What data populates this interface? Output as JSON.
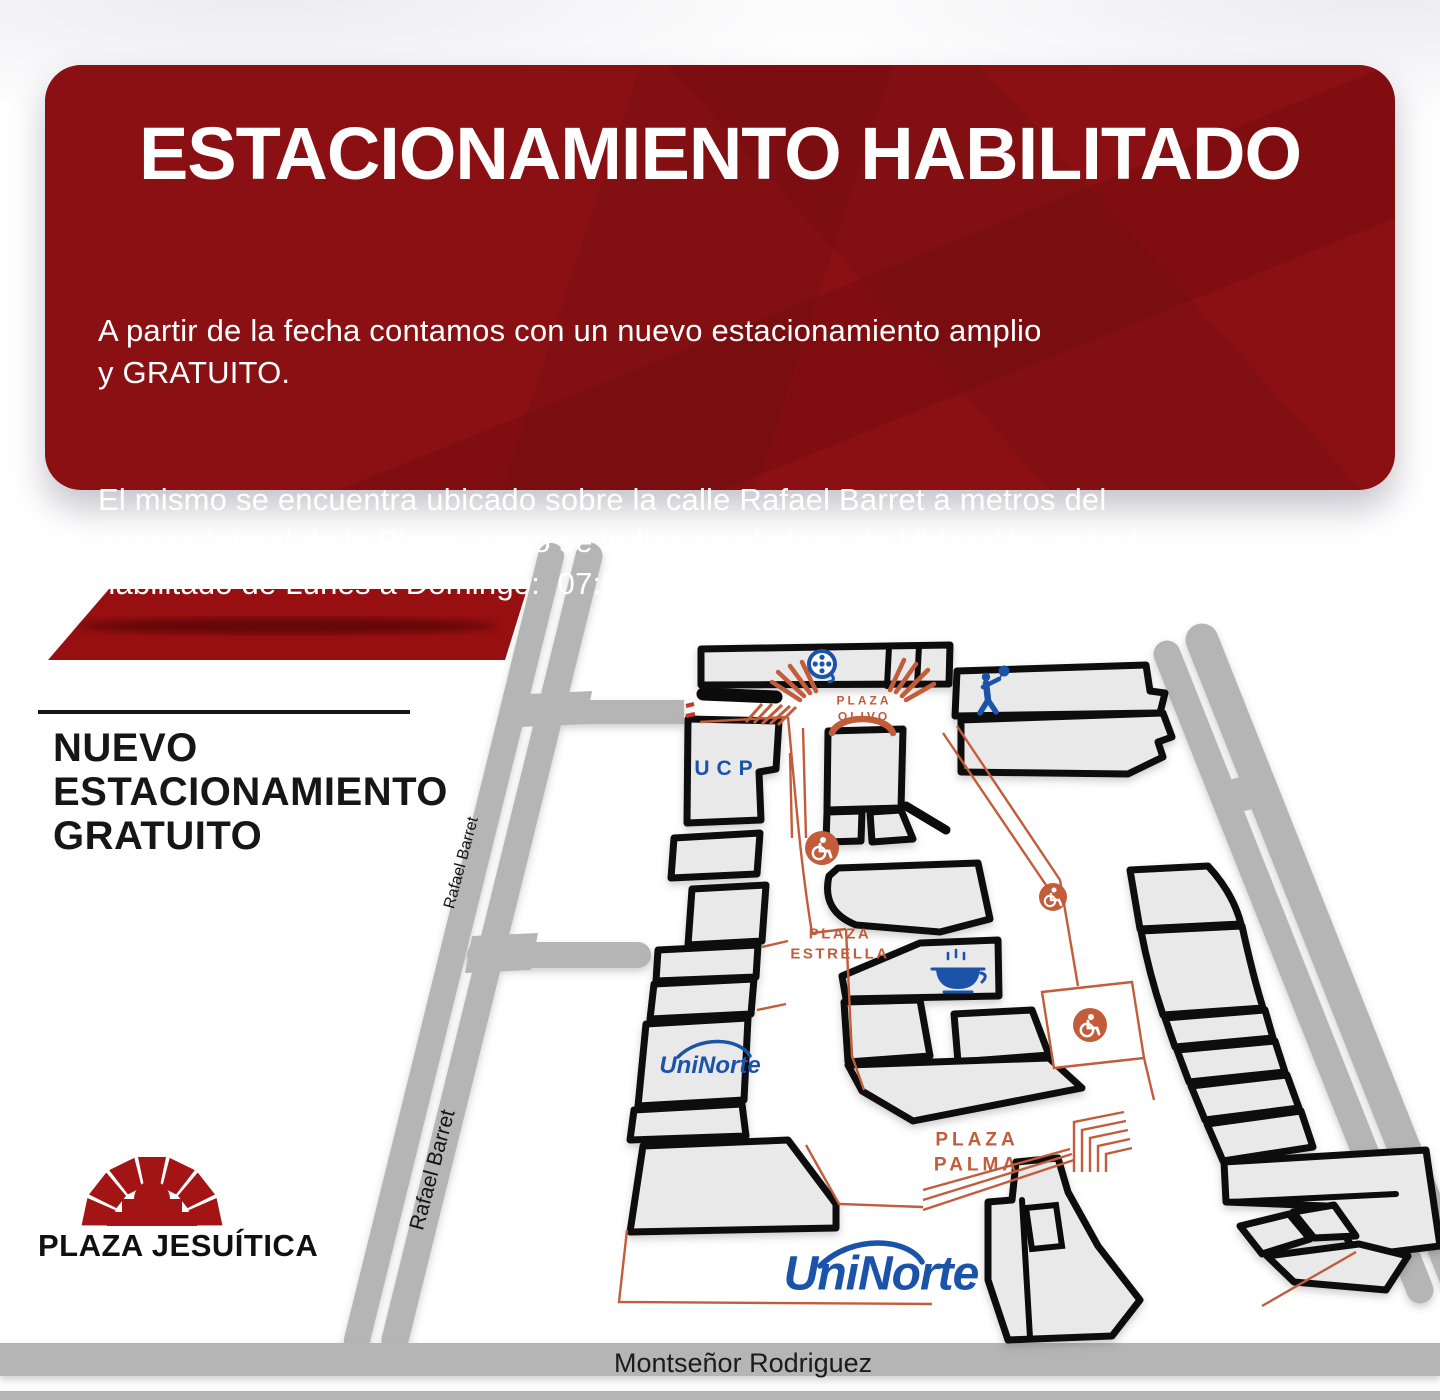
{
  "banner": {
    "title": "ESTACIONAMIENTO HABILITADO",
    "body_paragraph_1": "A partir de la fecha contamos con un nuevo estacionamiento amplio\ny GRATUITO.",
    "body_paragraph_2": "El mismo se encuentra ubicado sobre la calle Rafael Barret a metros del\nacceso lateral de la Plaza, como se indica en el plano de Ubicación, estará\nhabilitado de Lunes a Domingo:  07:00Hs a 00:00Hs.",
    "bg_color": "#8a1013",
    "text_color": "#ffffff"
  },
  "parking_callout": {
    "label": "NUEVO\nESTACIONAMIENTO\nGRATUITO",
    "lot_color": "#970f10"
  },
  "streets": {
    "rafael_barret": "Rafael Barret",
    "montsenor_rodriguez": "Montseñor Rodriguez",
    "road_color": "#b5b5b5"
  },
  "mall": {
    "areas": {
      "plaza_olivo": "PLAZA\nOLIVO",
      "plaza_estrella": "PLAZA\nESTRELLA",
      "plaza_palma": "PLAZA\nPALMA"
    },
    "tenants": {
      "ucp": "UCP",
      "uninorte": "UniNorte"
    },
    "building_fill": "#e9e9e9",
    "outline_color": "#0b0b0b",
    "walkway_orange": "#c25c3a",
    "brand_blue": "#1a53a8",
    "icons": [
      {
        "name": "cinema-reel-icon",
        "color": "#1a53a8"
      },
      {
        "name": "kids-balloon-icon",
        "color": "#1a53a8"
      },
      {
        "name": "coffee-cup-icon",
        "color": "#1a53a8"
      },
      {
        "name": "wheelchair-icon",
        "color": "#c25c3a",
        "count": 3
      },
      {
        "name": "stairs-icon",
        "color": "#c25c3a"
      }
    ]
  },
  "footer": {
    "logo_text": "PLAZA JESUÍTICA",
    "logo_color": "#a31414"
  }
}
